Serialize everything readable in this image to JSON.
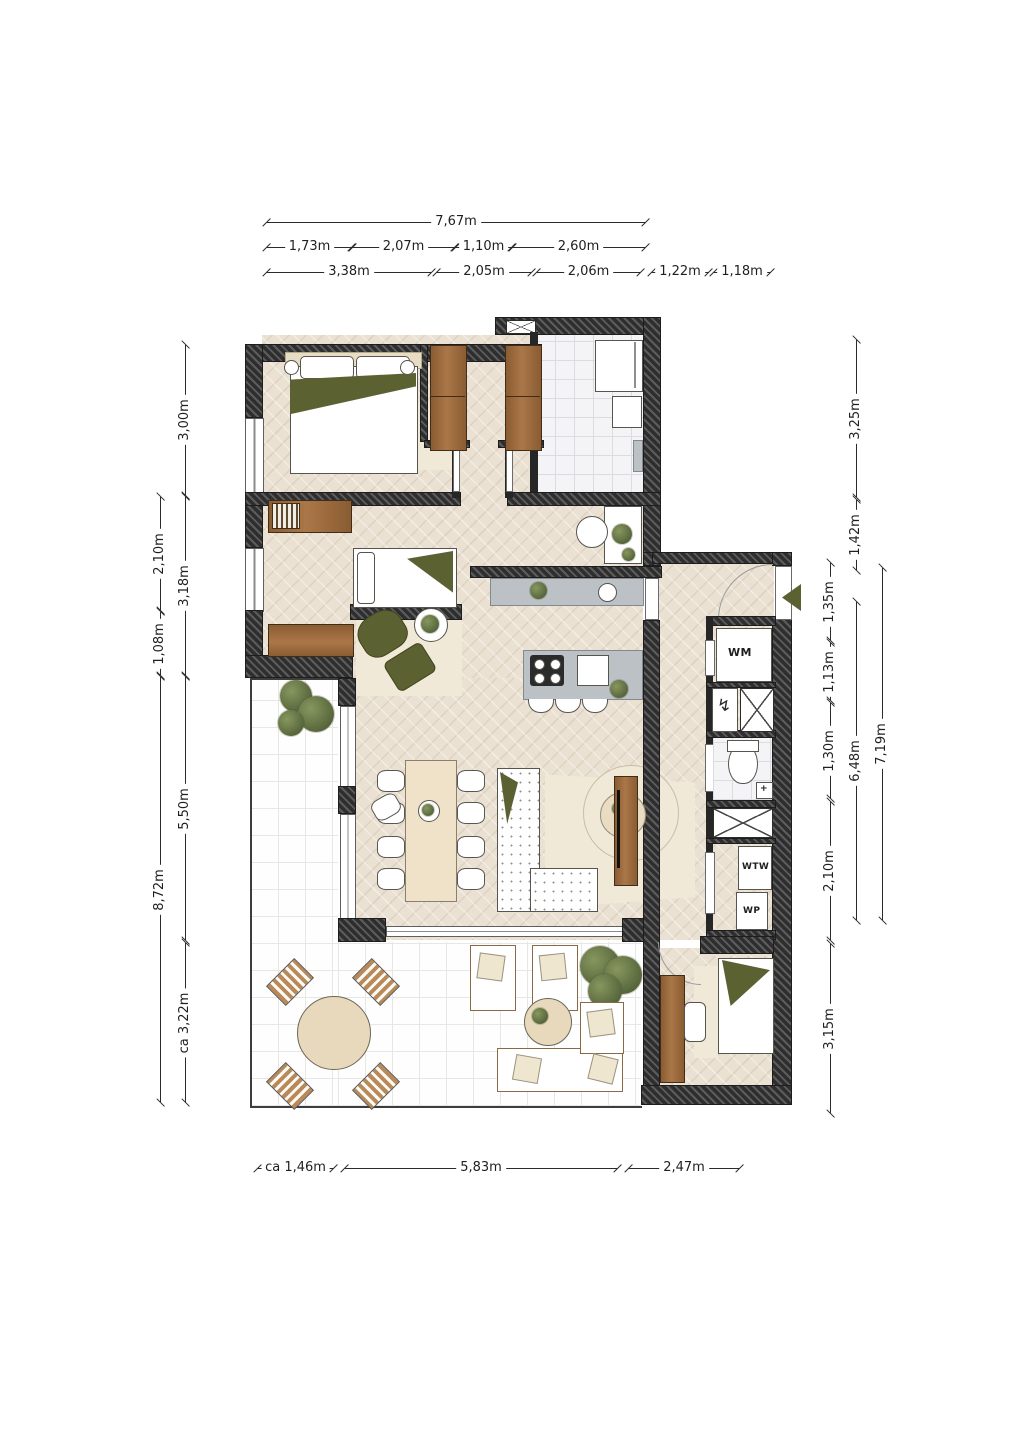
{
  "title": "apartment-floor-plan",
  "dims": {
    "top1": [
      "7,67m"
    ],
    "top2": [
      "1,73m",
      "2,07m",
      "1,10m",
      "2,60m"
    ],
    "top3": [
      "3,38m",
      "2,05m",
      "2,06m",
      "1,22m",
      "1,18m"
    ],
    "bottom": [
      "ca 1,46m",
      "5,83m",
      "2,47m"
    ],
    "left_outer": [
      "2,10m",
      "1,08m",
      "8,72m"
    ],
    "left_inner": [
      "3,00m",
      "3,18m",
      "5,50m",
      "ca 3,22m"
    ],
    "right_inner": [
      "1,35m",
      "1,13m",
      "1,30m",
      "2,10m",
      "3,15m"
    ],
    "right_middle": [
      "3,25m",
      "1,42m",
      "6,48m"
    ],
    "right_outer": [
      "7,19m"
    ]
  },
  "labels": {
    "washing_machine": "WM",
    "heat_recovery": "WTW",
    "heat_pump": "WP",
    "basin_plus": "+",
    "meter_bolt": "↯"
  },
  "colors": {
    "wall": "#2e2e2e",
    "wood_floor": "#eae1d2",
    "tile_floor": "#f4f4f6",
    "terrace_floor": "#fefefe",
    "furniture_wood": "#9b6a3e",
    "counter_gray": "#bcc1c6",
    "accent_olive": "#5c6132",
    "rug_beige": "#f1e9d8"
  }
}
